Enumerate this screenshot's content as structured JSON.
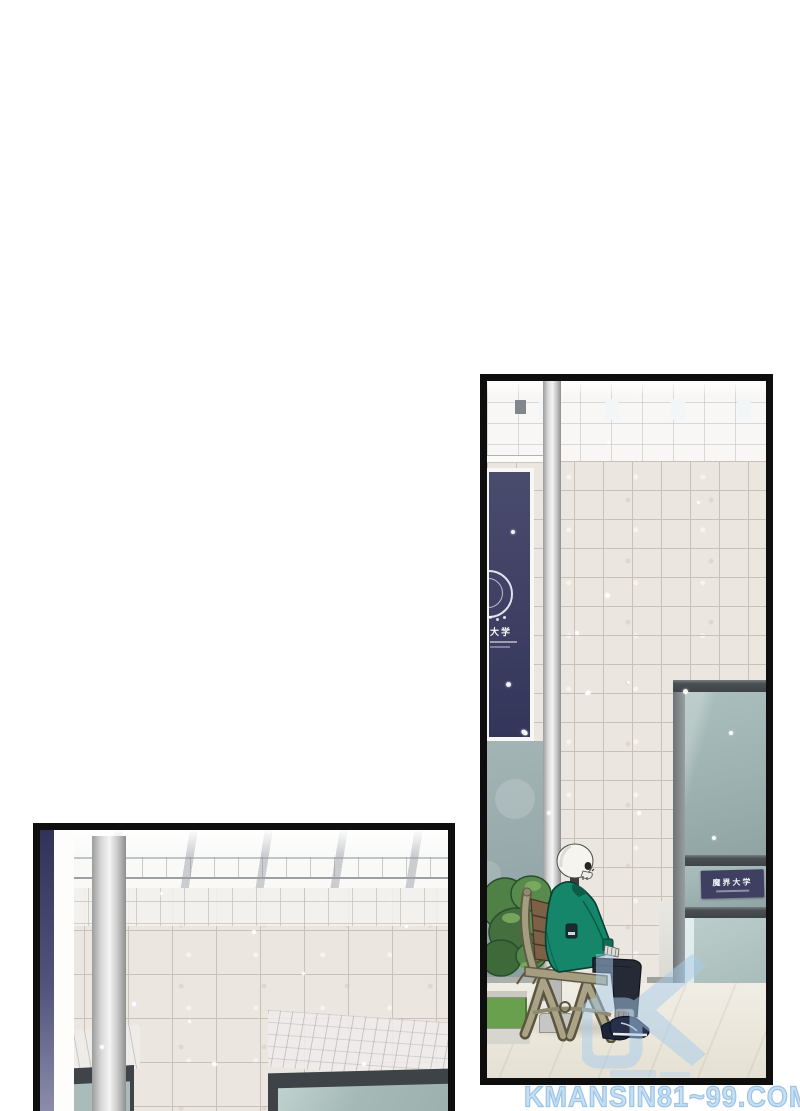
{
  "page": {
    "background_color": "#ffffff",
    "type": "webtoon-comic-page"
  },
  "panels": {
    "right": {
      "banner": {
        "emblem_label": "大学"
      },
      "entrance_sign": {
        "label": "魔界大学"
      }
    },
    "left": {}
  },
  "watermark": {
    "site_text": "KMANSIN81~99.COM",
    "logo_icon": "k-chevron-logo"
  },
  "colors": {
    "page_bg": "#ffffff",
    "panel_border": "#0e0e0e",
    "tile_wall": "#ece6e1",
    "tile_grout": "#c9c0b8",
    "banner_navy": "#3e3f63",
    "sign_navy": "#3f4061",
    "glass_teal": "#a3b7b5",
    "frame_dark": "#4a4f53",
    "jacket_green": "#15866a",
    "bench_olive": "#a49d80",
    "bush_green": "#4f8147",
    "grass_green": "#68a04e",
    "floor_color": "#efece3",
    "watermark_blue": "#c7dff2",
    "purple_strip": "#53547c"
  }
}
